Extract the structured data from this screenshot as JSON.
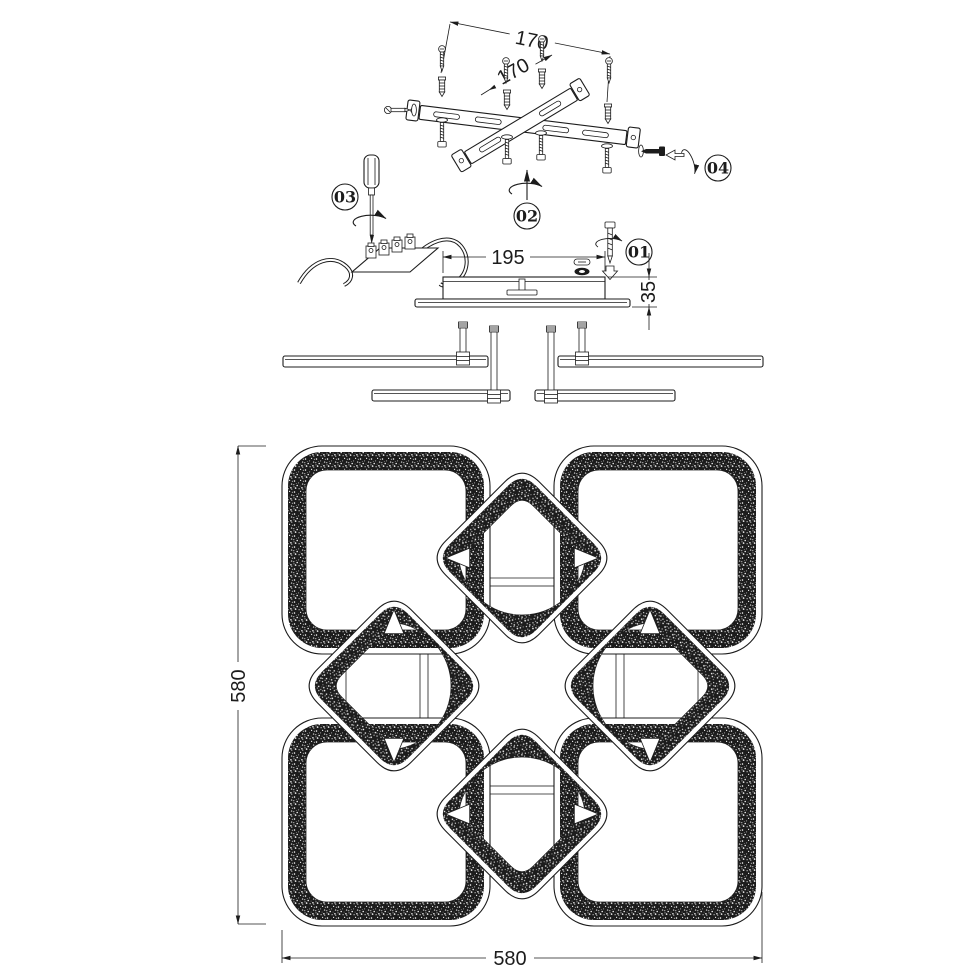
{
  "colors": {
    "ink": "#1c1c1c",
    "paper": "#ffffff"
  },
  "steps": [
    {
      "label": "01"
    },
    {
      "label": "02"
    },
    {
      "label": "03"
    },
    {
      "label": "04"
    }
  ],
  "dimensions": {
    "bracket_hole_spacing_a": "170",
    "bracket_hole_spacing_b": "170",
    "canopy_length": "195",
    "canopy_height": "35",
    "fixture_height": "580",
    "fixture_width": "580"
  }
}
